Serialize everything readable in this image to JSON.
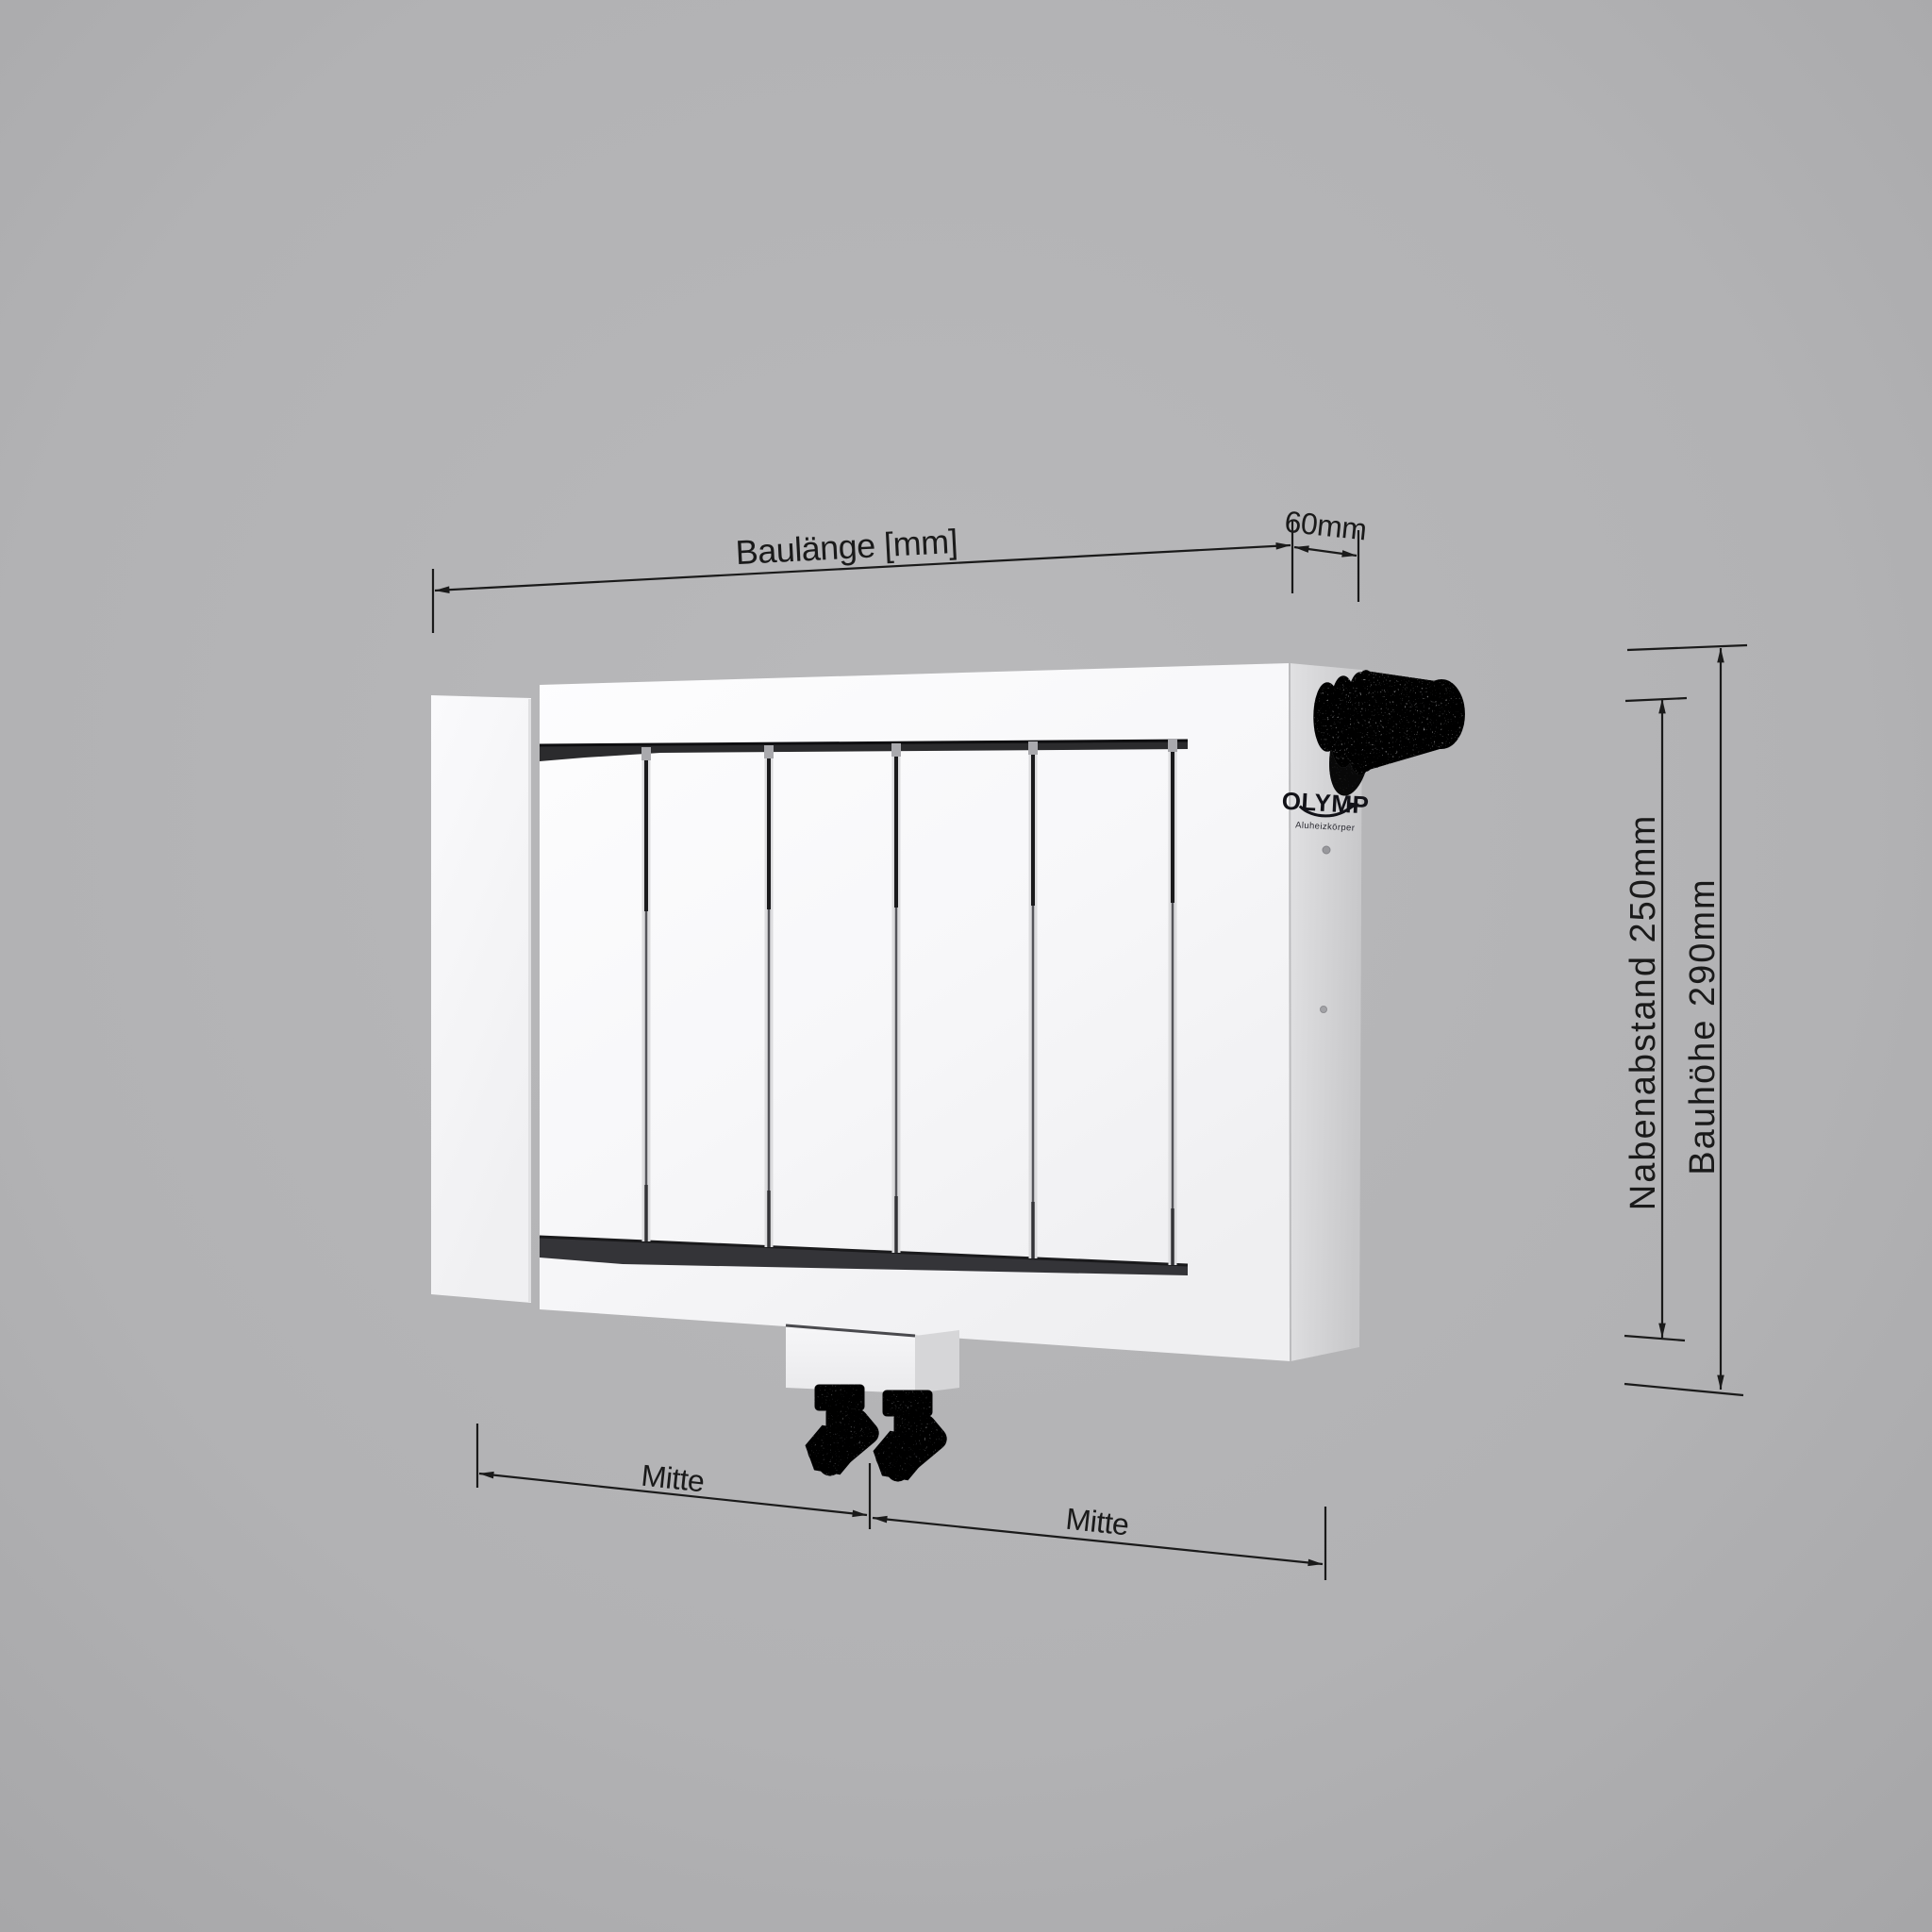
{
  "scene": {
    "type": "radiator-dimension-drawing",
    "background_color": "#b2b2b4"
  },
  "radiator": {
    "brand_logo": "OLYMP",
    "brand_logo_subline": "Aluheizkörper",
    "panel_count": 5,
    "front_color": "#f7f7f9",
    "side_color": "#d3d3d5",
    "shadow_strip_color": "#2b2b2d"
  },
  "dimensions": {
    "baulaenge": {
      "label": "Baulänge [mm]"
    },
    "tiefe": {
      "label": "60mm",
      "value_mm": 60
    },
    "nabenabstand": {
      "label": "Nabenabstand 250mm",
      "value_mm": 250
    },
    "bauhoehe": {
      "label": "Bauhöhe 290mm",
      "value_mm": 290
    },
    "mitte_links": {
      "label": "Mitte"
    },
    "mitte_rechts": {
      "label": "Mitte"
    }
  },
  "colors": {
    "dimension_lines": "#1a1a1a"
  }
}
